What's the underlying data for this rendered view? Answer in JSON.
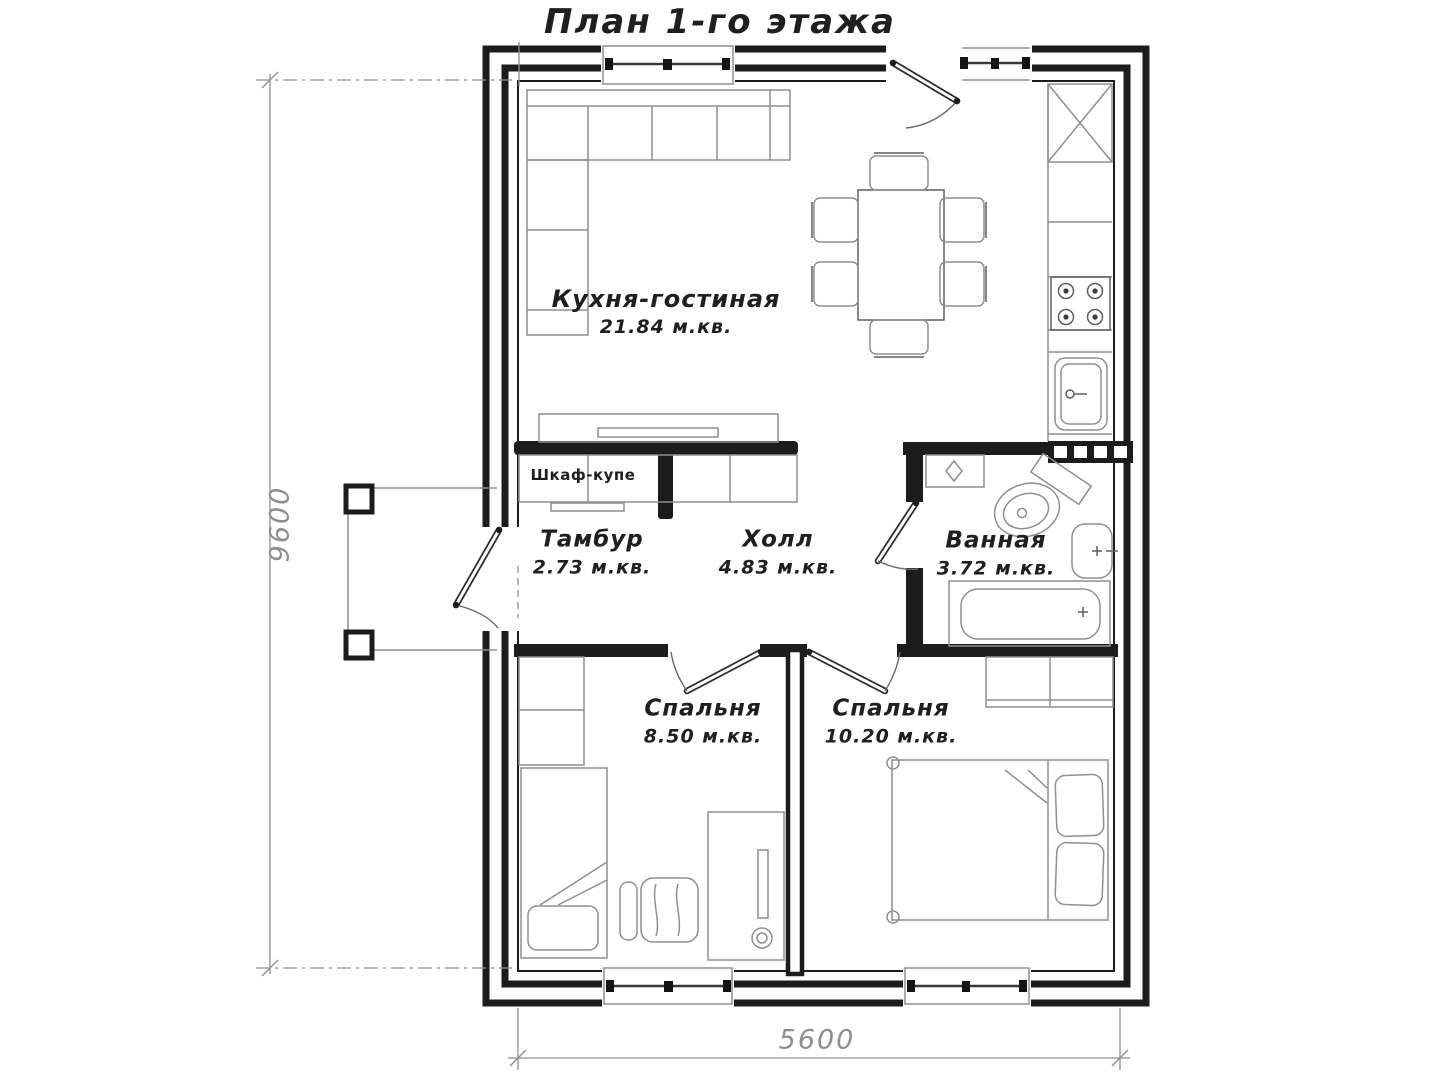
{
  "title": "План 1-го этажа",
  "rooms": [
    {
      "name": "Кухня-гостиная",
      "area": "21.84 м.кв."
    },
    {
      "name": "Тамбур",
      "area": "2.73 м.кв."
    },
    {
      "name": "Холл",
      "area": "4.83 м.кв."
    },
    {
      "name": "Ванная",
      "area": "3.72 м.кв."
    },
    {
      "name": "Спальня",
      "area": "8.50 м.кв."
    },
    {
      "name": "Спальня",
      "area": "10.20 м.кв."
    }
  ],
  "annotations": {
    "wardrobe": "Шкаф-купе"
  },
  "dimensions": {
    "vertical": "9600",
    "horizontal": "5600"
  },
  "colors": {
    "wall": "#1c1c1c",
    "furniture": "#8f8f8f",
    "dimension": "#8f8f8f",
    "text": "#1f1f1f"
  }
}
